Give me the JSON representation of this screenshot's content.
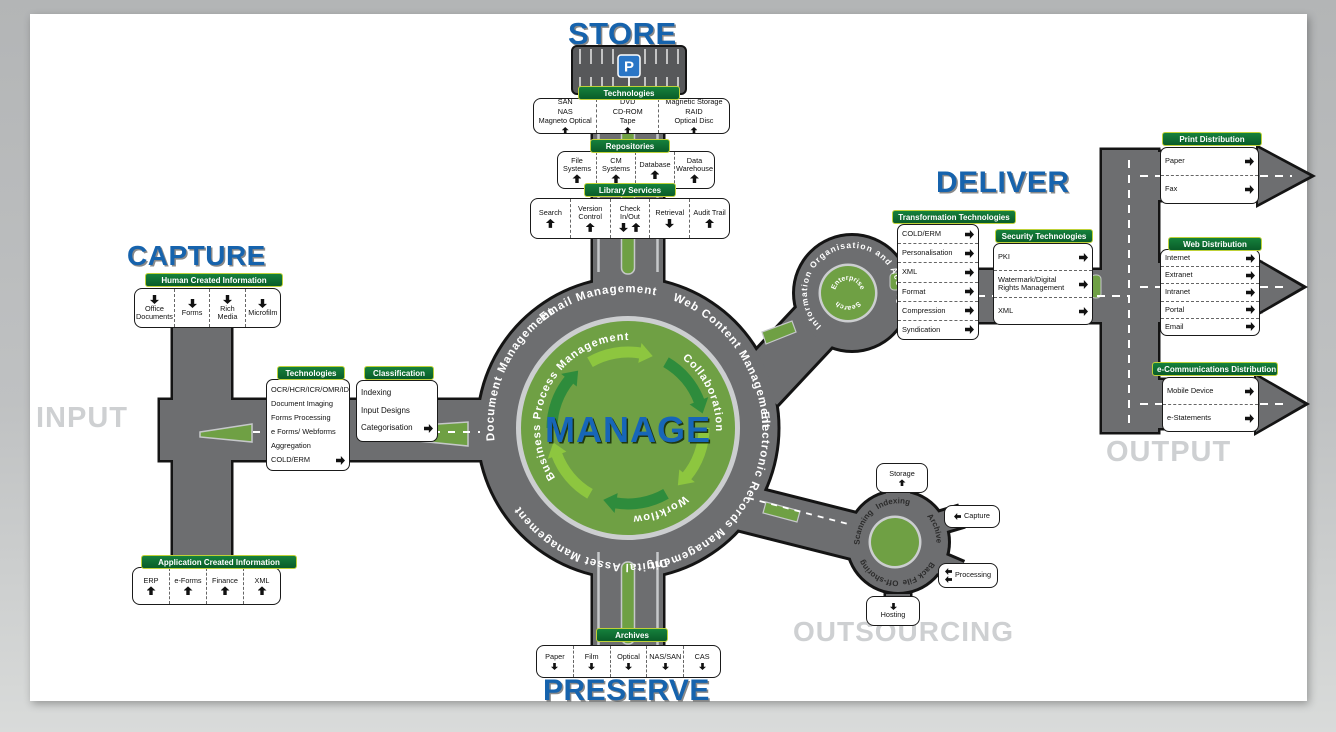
{
  "titles": {
    "store": "STORE",
    "capture": "CAPTURE",
    "deliver": "DELIVER",
    "preserve": "PRESERVE",
    "input": "INPUT",
    "output": "OUTPUT",
    "outsourcing": "OUTSOURCING",
    "manage": "MANAGE"
  },
  "store": {
    "technologies": {
      "label": "Technologies",
      "cells": [
        [
          "SAN",
          "NAS",
          "Magneto Optical"
        ],
        [
          "DVD",
          "CD-ROM",
          "Tape"
        ],
        [
          "Magnetic Storage",
          "RAID",
          "Optical Disc"
        ]
      ]
    },
    "repositories": {
      "label": "Repositories",
      "cells": [
        "File Systems",
        "CM Systems",
        "Database",
        "Data Warehouse"
      ]
    },
    "library": {
      "label": "Library Services",
      "cells": [
        "Search",
        "Version Control",
        "Check In/Out",
        "Retrieval",
        "Audit Trail"
      ]
    }
  },
  "capture": {
    "human": {
      "label": "Human Created Information",
      "cells": [
        "Office Documents",
        "Forms",
        "Rich Media",
        "Microfilm"
      ]
    },
    "application": {
      "label": "Application Created Information",
      "cells": [
        "ERP",
        "e-Forms",
        "Finance",
        "XML"
      ]
    },
    "technologies": {
      "label": "Technologies",
      "rows": [
        "OCR/HCR/ICR/OMR/IDR",
        "Document Imaging",
        "Forms Processing",
        "e Forms/ Webforms",
        "Aggregation",
        "COLD/ERM"
      ]
    },
    "classification": {
      "label": "Classification",
      "rows": [
        "Indexing",
        "Input Designs",
        "Categorisation"
      ]
    }
  },
  "manage": {
    "outer_ring": [
      "Document Management",
      "Email Management",
      "Web Content Management",
      "Electronic Records Management",
      "Digital Asset Management"
    ],
    "inner_ring": [
      "Business Process Management",
      "Collaboration",
      "Workflow"
    ]
  },
  "deliver": {
    "info_access": "Information Organisation and Access",
    "enterprise_top": "Enterprise",
    "enterprise_bottom": "Search",
    "transformation": {
      "label": "Transformation Technologies",
      "rows": [
        "COLD/ERM",
        "Personalisation",
        "XML",
        "Format",
        "Compression",
        "Syndication"
      ]
    },
    "security": {
      "label": "Security Technologies",
      "rows": [
        "PKI",
        "Watermark/Digital Rights Management",
        "XML"
      ]
    },
    "print": {
      "label": "Print Distribution",
      "rows": [
        "Paper",
        "Fax"
      ]
    },
    "web": {
      "label": "Web Distribution",
      "rows": [
        "Internet",
        "Extranet",
        "Intranet",
        "Portal",
        "Email"
      ]
    },
    "ecomm": {
      "label": "e-Communications Distribution",
      "rows": [
        "Mobile Device",
        "e-Statements"
      ]
    }
  },
  "outsourcing": {
    "ring": [
      "Scanning",
      "Indexing",
      "Archive",
      "Back File",
      "Off-shoring"
    ],
    "storage": "Storage",
    "capture": "Capture",
    "processing": "Processing",
    "hosting": "Hosting"
  },
  "preserve": {
    "archives": {
      "label": "Archives",
      "cells": [
        "Paper",
        "Film",
        "Optical",
        "NAS/SAN",
        "CAS"
      ]
    }
  },
  "colors": {
    "road": "#6d6e70",
    "green": "#6fa044",
    "label_green": "#0e6b31",
    "accent_blue": "#1663ad",
    "muted_gray": "#ced0d2",
    "arrow_dark_green": "#2e8c3c",
    "arrow_light_green": "#8dc63f"
  }
}
